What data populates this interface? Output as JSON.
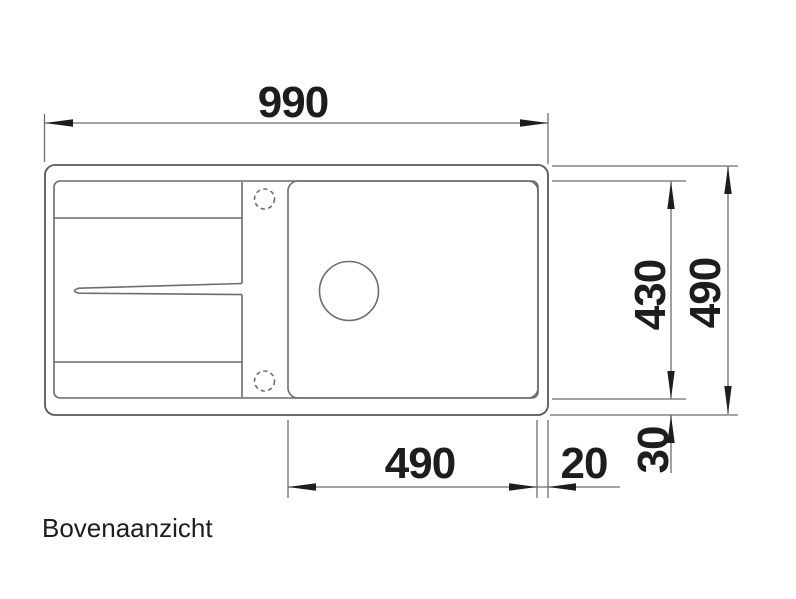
{
  "drawing": {
    "view_label": "Bovenaanzicht",
    "dims": {
      "overall_width": "990",
      "overall_depth": "490",
      "bowl_depth": "430",
      "bowl_width": "490",
      "rim_right": "20",
      "rim_bottom": "30"
    },
    "colors": {
      "background": "#ffffff",
      "line": "#6a6c6f",
      "outline": "#56585b",
      "text": "#1d1d1b"
    }
  }
}
